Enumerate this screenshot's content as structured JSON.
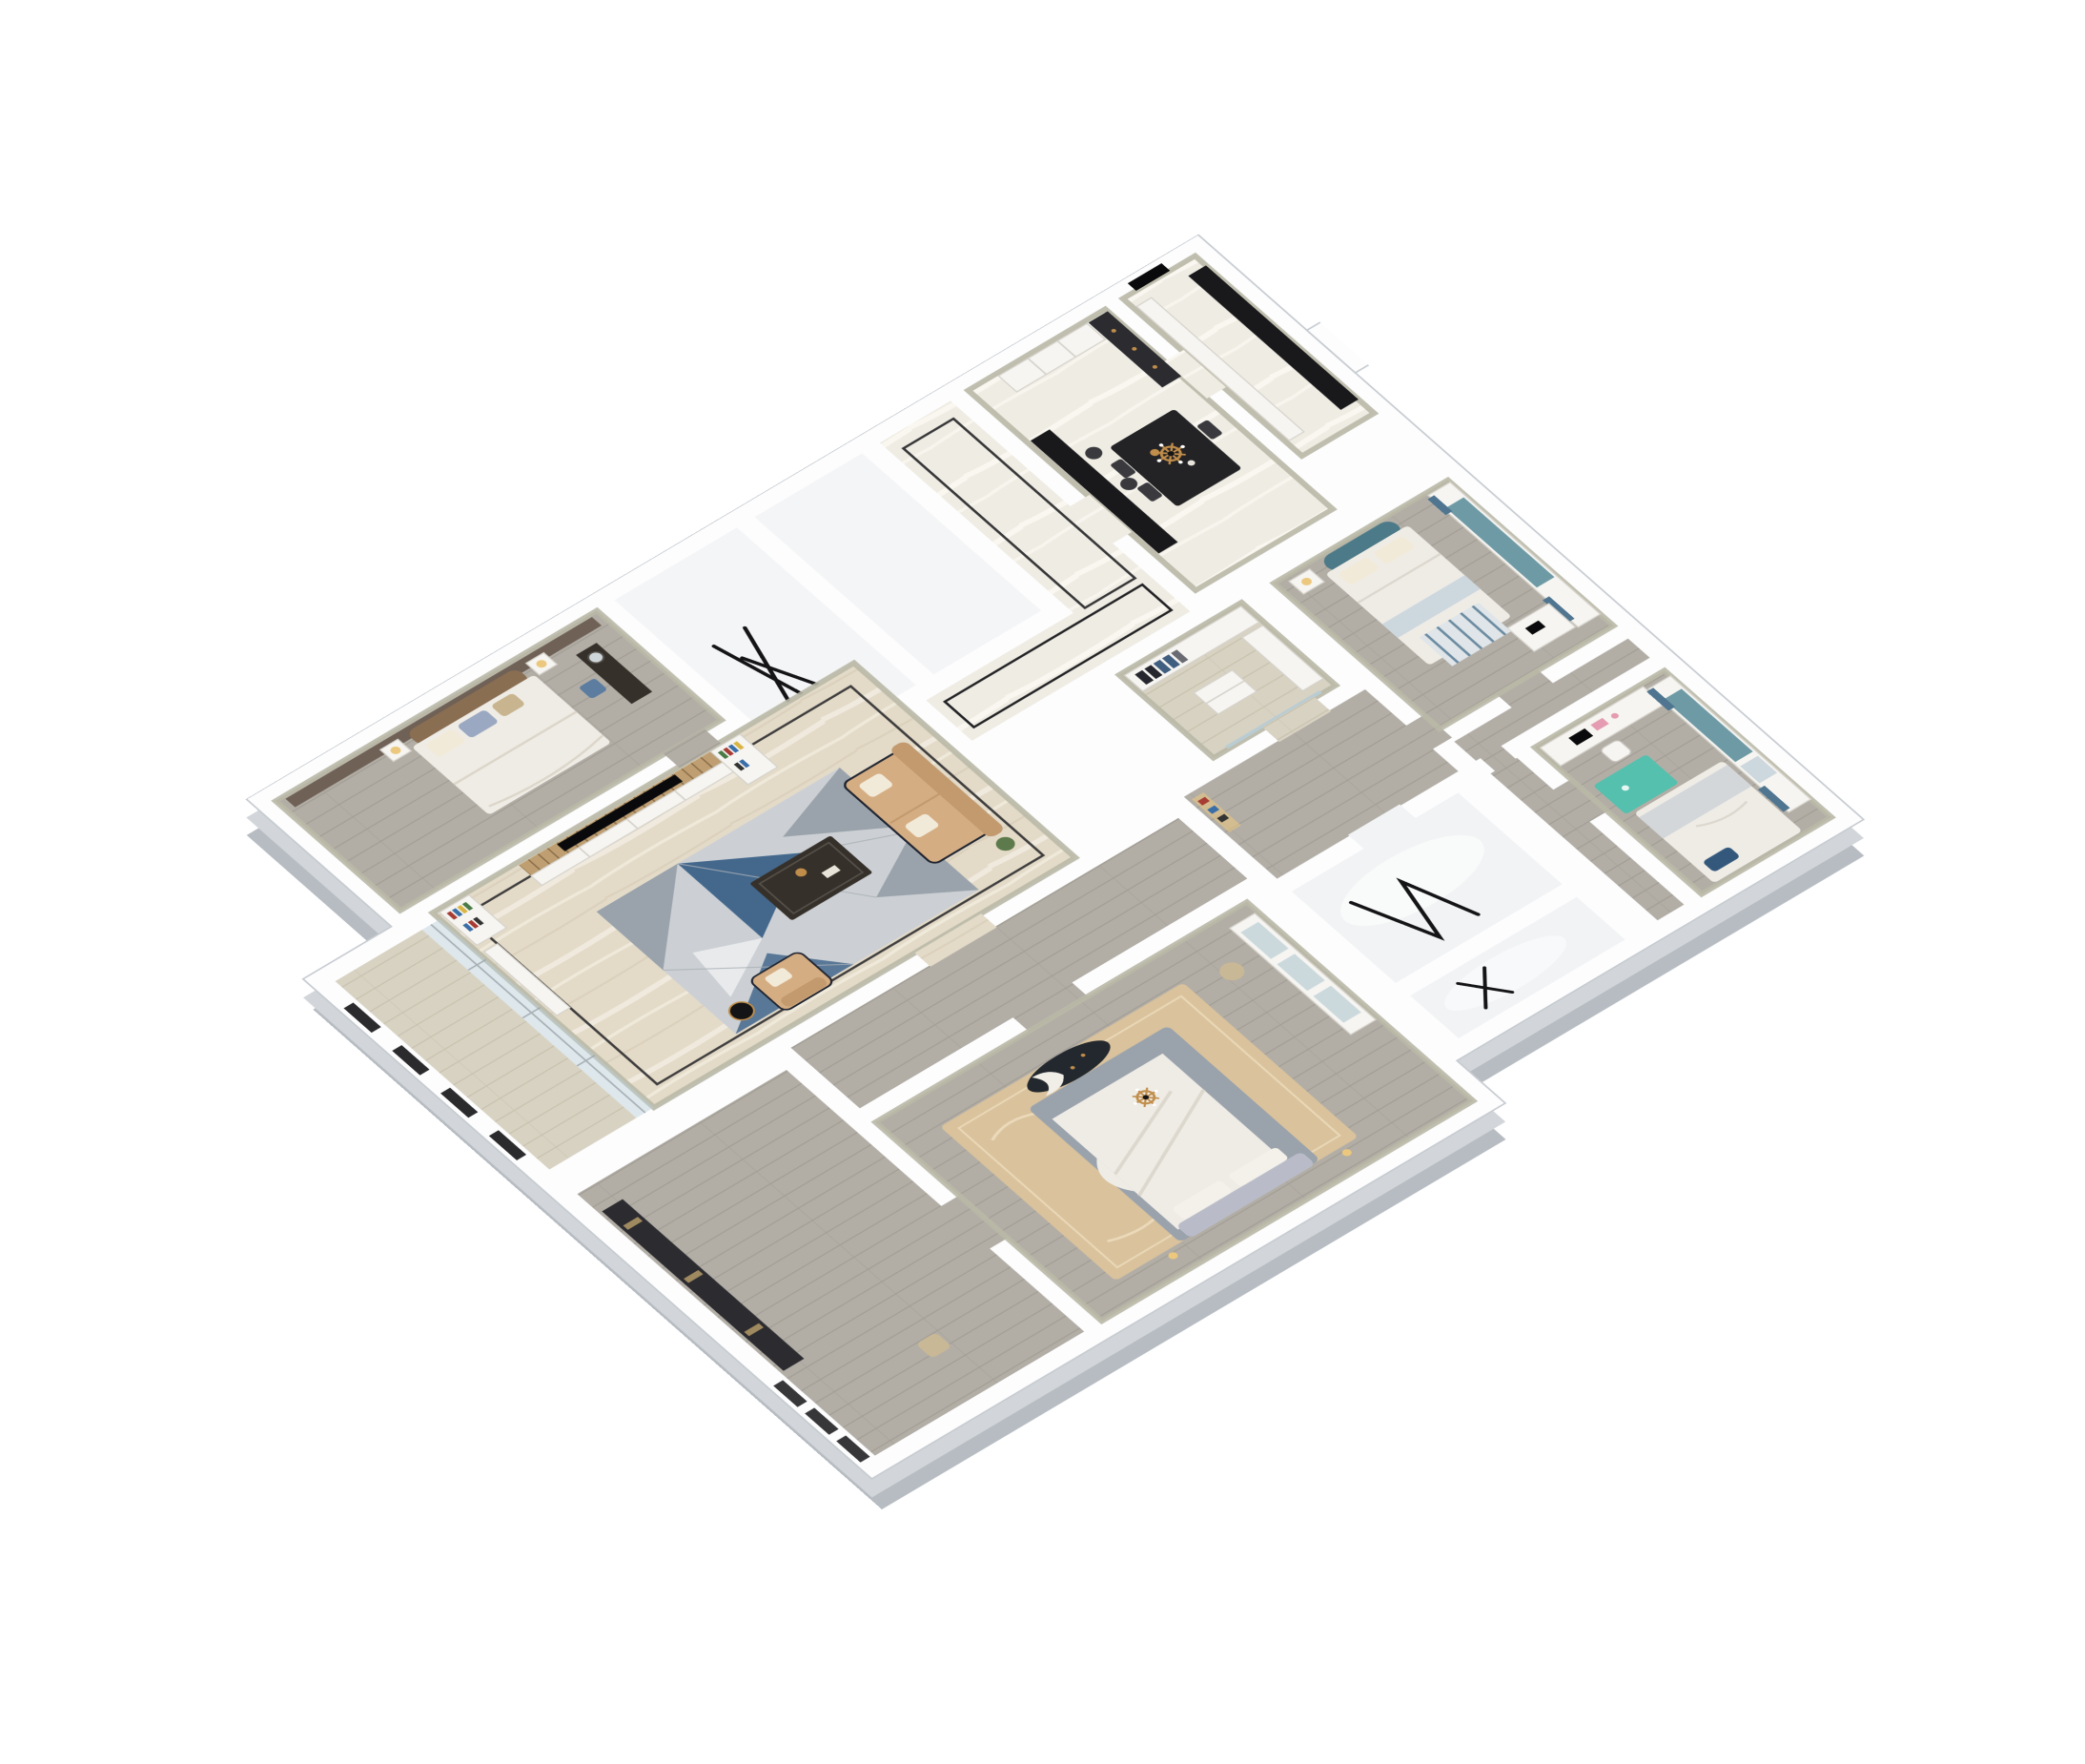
{
  "scene": {
    "title": "3D axonometric cutaway floor plan render of a furnished apartment, white background",
    "type": "dollhouse-floor-plan-render"
  },
  "palette": {
    "page_bg": "#ffffff",
    "wall_white": "#fdfdfe",
    "wall_edge": "#c6cbd0",
    "wall_top_sage": "#b9b8a6",
    "slab": "#d2d6da",
    "slab_dark": "#b6bcc2",
    "floor_marble_beige": "#e3dac8",
    "marble_streak": "#f2ecdf",
    "marble_dark": "#d2c6ae",
    "floor_marble_light": "#efece3",
    "marble_streak_light": "#f9f7f0",
    "floor_wood_gray": "#b2aea6",
    "wood_gray_line": "#a19d95",
    "floor_wood_light": "#d8d2c2",
    "wood_light_line": "#c7c0ae",
    "floor_bath": "#f1f3f4",
    "floor_white_soft": "#f4f5f6",
    "inlay_black": "#212124",
    "metal_black": "#141416",
    "rug_silver": "#ccd0d4",
    "rug_gray": "#9aa3ab",
    "rug_blue": "#44688c",
    "rug_navy": "#2e4a68",
    "rug_white": "#e9eaec",
    "rug_beige": "#d9c29c",
    "rug_beige_light": "#ecdcbd",
    "rug_teal": "#54c0ad",
    "sofa_tan": "#d5ad83",
    "sofa_tan_dark": "#c29a6e",
    "trim_navy": "#1f2430",
    "pillow_cream": "#f2ead8",
    "pillow_blue": "#9aa8c2",
    "pillow_tan": "#c8b48e",
    "pillow_navy": "#33587c",
    "table_dark": "#36302a",
    "table_black": "#232326",
    "seat_dark": "#3a3a3e",
    "counter_black": "#19191c",
    "gold": "#c08d4a",
    "lamp_warm": "#ecc87e",
    "plant_green": "#5d7a4c",
    "furniture_white": "#f6f5f1",
    "furniture_edge": "#d6d3cc",
    "wood_slat": "#bf9f72",
    "wood_slat_line": "#8a6d48",
    "tv_black": "#0a0a0c",
    "book_red": "#a63c34",
    "book_blue": "#3a6ea8",
    "book_yellow": "#d9b544",
    "book_green": "#4a7a46",
    "panel_taupe": "#6f6156",
    "headboard_brown": "#8a6e52",
    "bed_white": "#efece6",
    "headboard_gray": "#b9bcc8",
    "bed_base_gray": "#9aa2ac",
    "blanket_gray": "#d3d7da",
    "blanket_blue": "#cdd8de",
    "teal_headboard": "#4d7a88",
    "cushion_teal": "#6e9aa5",
    "curtain_blue": "#4f7590",
    "clothes_dark": "#26262e",
    "clothes_gray": "#6a6a72",
    "jeans_blue": "#3f5e80",
    "glass_blue": "#b9cdd4",
    "cabinet_dark": "#2b2b30",
    "pink": "#e59bb1",
    "stool_tan": "#c9b896",
    "bench_dark": "#23282e"
  },
  "rooms": [
    {
      "id": "bedroom-left",
      "label": "bedroom with brown upholstered headboard",
      "floor": "gray wood planks",
      "furniture": [
        "taupe panel wall",
        "double bed",
        "white and blue pillows",
        "two nightstands",
        "warm table lamps",
        "dark vanity desk",
        "round mirror",
        "blue chair"
      ]
    },
    {
      "id": "utility-room-a",
      "label": "empty white room",
      "floor": "white",
      "furniture": [
        "black ladder rack"
      ]
    },
    {
      "id": "utility-room-b",
      "label": "empty white room",
      "floor": "white",
      "furniture": []
    },
    {
      "id": "entry-hall",
      "label": "entry hall",
      "floor": "light marble with black inlay border",
      "furniture": []
    },
    {
      "id": "dining-room",
      "label": "dining room",
      "floor": "light marble",
      "furniture": [
        "black bar counter",
        "bar stools",
        "black dining table",
        "black chairs",
        "brass candle chandelier",
        "white sideboard with drawers",
        "dark display cabinet"
      ]
    },
    {
      "id": "kitchen",
      "label": "kitchen block at top corner",
      "floor": "light marble",
      "furniture": [
        "white cabinet run",
        "dark counter",
        "black door"
      ]
    },
    {
      "id": "living-room",
      "label": "living room",
      "floor": "beige marble with black inlay border",
      "furniture": [
        "wood-slat TV wall",
        "flat TV",
        "white media cabinet",
        "bookshelves with colorful books",
        "tall side cabinet",
        "geometric triangle rug",
        "tan sofa with navy trim",
        "tan armchair",
        "dark coffee table with brass tray",
        "black drum side table",
        "potted plant"
      ]
    },
    {
      "id": "walk-in-closet",
      "label": "walk-in closet",
      "floor": "light wood planks",
      "furniture": [
        "wardrobe with hanging jackets and jeans",
        "island drawer unit",
        "side wardrobe",
        "glass doors"
      ]
    },
    {
      "id": "hallway-north",
      "label": "hallway",
      "floor": "light marble with black inlay loop",
      "furniture": []
    },
    {
      "id": "hallway-south",
      "label": "hallway",
      "floor": "gray wood planks",
      "furniture": [
        "lit display niche"
      ]
    },
    {
      "id": "bedroom-blue",
      "label": "bedroom with teal curved headboard",
      "floor": "gray wood planks",
      "furniture": [
        "bed with white duvet",
        "teal curved headboard",
        "nightstand with warm lamp",
        "bay window seat with teal cushion",
        "blue curtains",
        "desk with laptop",
        "striped rug"
      ]
    },
    {
      "id": "bedroom-kids",
      "label": "kids bedroom",
      "floor": "gray wood planks",
      "furniture": [
        "study desk with monitor",
        "pink accessories",
        "white chair",
        "mint rug",
        "bed with navy pillow",
        "bay window seat",
        "blue curtains",
        "blue throw"
      ]
    },
    {
      "id": "bathroom-a",
      "label": "bathroom",
      "floor": "glossy white",
      "furniture": [
        "black folding drying rack"
      ]
    },
    {
      "id": "bathroom-b",
      "label": "bathroom",
      "floor": "glossy white",
      "furniture": [
        "black folding rack"
      ]
    },
    {
      "id": "master-bedroom",
      "label": "master bedroom",
      "floor": "gray wood planks",
      "furniture": [
        "ornate beige rug",
        "bed with gray base and white duvet",
        "gray headboard with pillows",
        "dark patterned oval bench",
        "brass candle chandelier",
        "glass-front display cabinet",
        "round stool"
      ]
    },
    {
      "id": "dressing-corridor",
      "label": "dressing corridor",
      "floor": "gray wood planks",
      "furniture": [
        "dark wardrobe band",
        "small chair",
        "black framed windows"
      ]
    },
    {
      "id": "balcony",
      "label": "balcony",
      "floor": "light wood planks",
      "furniture": [
        "glass partition to living room",
        "black framed exterior windows"
      ]
    }
  ]
}
